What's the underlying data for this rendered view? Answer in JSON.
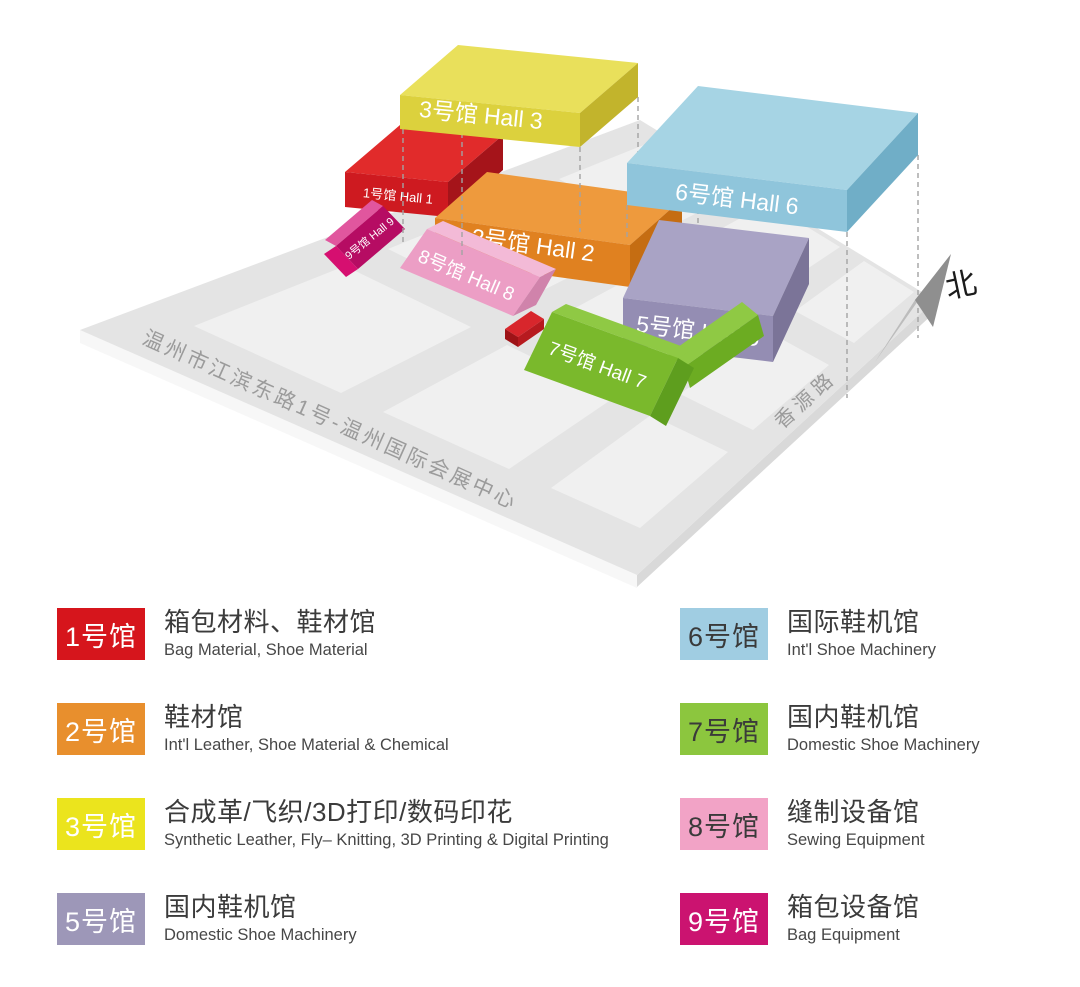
{
  "map": {
    "label_color": "#ffffff",
    "ground": {
      "road_color": "#e4e4e4",
      "block_color": "#f0f0f0",
      "edge_left_color": "#f7f7f7",
      "edge_right_color": "#d9d9d9",
      "road_label_color": "#9b9b9b",
      "dash_color": "#a3a3a3"
    },
    "address_label": "温州市江滨东路1号-温州国际会展中心",
    "road_label": "香源路",
    "north": {
      "label": "北",
      "label_color": "#1b1b1b",
      "arrow_light": "#bcbcbc",
      "arrow_dark": "#8f8f8f"
    },
    "halls": [
      {
        "id": "hall-3",
        "label": "3号馆 Hall 3",
        "colors": {
          "top": "#e9e05b",
          "front": "#dcd13d",
          "side": "#c2b42c"
        }
      },
      {
        "id": "hall-6",
        "label": "6号馆 Hall 6",
        "colors": {
          "top": "#a6d4e4",
          "front": "#8fc5db",
          "side": "#70aec7"
        }
      },
      {
        "id": "hall-1",
        "label": "1号馆 Hall 1",
        "colors": {
          "top": "#e12b2b",
          "front": "#ce1a20",
          "side": "#a5141a"
        }
      },
      {
        "id": "hall-2",
        "label": "2号馆 Hall 2",
        "colors": {
          "top": "#ee9a3d",
          "front": "#e08120",
          "side": "#c56d12"
        }
      },
      {
        "id": "hall-5",
        "label": "5号馆 Hall 5",
        "colors": {
          "top": "#a9a3c5",
          "front": "#948db3",
          "side": "#7b7498"
        }
      },
      {
        "id": "hall-8",
        "label": "8号馆 Hall 8",
        "colors": {
          "slope": "#ec9ec5",
          "strip": "#f3bad7",
          "gable": "#d083ab"
        }
      },
      {
        "id": "hall-7",
        "label": "7号馆 Hall 7",
        "colors": {
          "slope": "#7ab92c",
          "strip": "#8fc944",
          "gable": "#5e9e1e",
          "wing_light": "#8fc944",
          "wing_dark": "#6cac22"
        }
      },
      {
        "id": "hall-9",
        "label": "9号馆 Hall 9",
        "colors": {
          "slope": "#b60c63",
          "strip": "#e1569e",
          "gable": "#d60f70"
        }
      }
    ],
    "entrance_block": {
      "top": "#d8262c",
      "front": "#9e1317",
      "side": "#b71a1f"
    }
  },
  "legend": {
    "left": [
      {
        "badge": "1号馆",
        "title": "箱包材料、鞋材馆",
        "subtitle": "Bag Material, Shoe Material",
        "color": "#d6151c",
        "text_color": "#ffffff"
      },
      {
        "badge": "2号馆",
        "title": "鞋材馆",
        "subtitle": "Int'l Leather, Shoe Material & Chemical",
        "color": "#e88f2d",
        "text_color": "#ffffff"
      },
      {
        "badge": "3号馆",
        "title": "合成革/飞织/3D打印/数码印花",
        "subtitle": "Synthetic Leather, Fly– Knitting, 3D Printing & Digital Printing",
        "color": "#ebe41d",
        "text_color": "#ffffff"
      },
      {
        "badge": "5号馆",
        "title": "国内鞋机馆",
        "subtitle": "Domestic Shoe Machinery",
        "color": "#9d97b8",
        "text_color": "#ffffff"
      }
    ],
    "right": [
      {
        "badge": "6号馆",
        "title": "国际鞋机馆",
        "subtitle": "Int'l Shoe Machinery",
        "color": "#a0cde2",
        "text_color": "#3a3a3a"
      },
      {
        "badge": "7号馆",
        "title": "国内鞋机馆",
        "subtitle": "Domestic Shoe Machinery",
        "color": "#8cc63e",
        "text_color": "#3a3a3a"
      },
      {
        "badge": "8号馆",
        "title": "缝制设备馆",
        "subtitle": "Sewing Equipment",
        "color": "#f2a3c6",
        "text_color": "#3a3a3a"
      },
      {
        "badge": "9号馆",
        "title": "箱包设备馆",
        "subtitle": "Bag Equipment",
        "color": "#cb1370",
        "text_color": "#ffffff"
      }
    ]
  }
}
